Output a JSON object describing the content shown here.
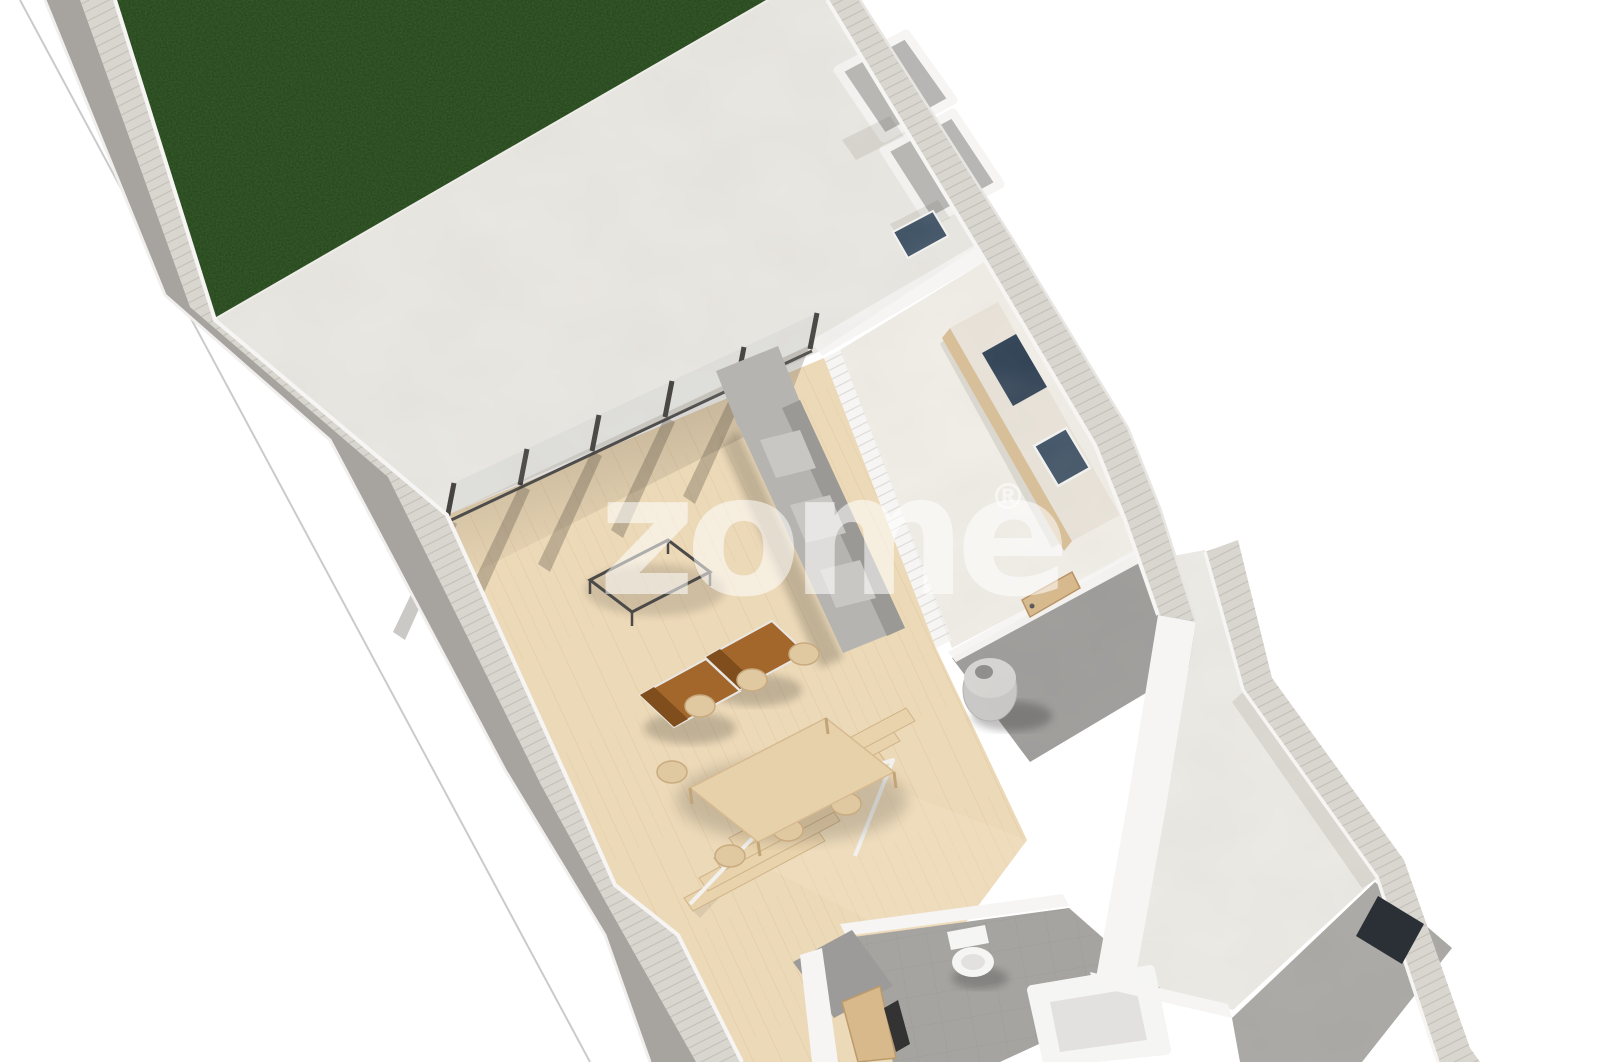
{
  "watermark": {
    "text": "zome",
    "reg": "®",
    "color": "rgba(255,255,255,0.55)"
  },
  "scene": {
    "description": "3D isometric render of a narrow townhouse ground-floor plan",
    "areas": [
      "garden-lawn",
      "front-patio",
      "living-room",
      "kitchen",
      "dining-area",
      "stairs",
      "bathroom",
      "utility-corridor",
      "back-yard",
      "storage-rooms",
      "garage-patio"
    ]
  },
  "c": {
    "background": "#ffffff",
    "property_line": "#cbcbcb",
    "grass": "#234119",
    "patio": "#eae8e3",
    "yard": "#edebe6",
    "corridor": "#9c9b99",
    "garage": "#a8a7a4",
    "wood": "#ecd9b8",
    "wall_top": "#d9d6d0",
    "wall_face": "#a7a4a0",
    "wall_white": "#f6f5f3",
    "divider": "#f0efec",
    "kitchen_floor": "#f2efe9",
    "counter_top": "#eae4da",
    "counter_side": "#d9bf97",
    "navy": "#3d5164",
    "navy_dark": "#2f4155",
    "sofa": "#b6b4b1",
    "sofa_light": "#c9c7c4",
    "sofa_dark": "#9b9996",
    "armchair": "#a3662b",
    "armchair_dark": "#7f4e1c",
    "armchair_frame": "#e9e7e3",
    "dining_wood": "#e7d1ab",
    "chair_wood": "#e0c8a1",
    "stair_wood": "#e9d3ad",
    "landing_wood": "#eedcbc",
    "bath_floor": "#a5a4a1",
    "fixture": "#f5f5f3",
    "fixture_shade": "#e2e1df",
    "heater": "#c9c8c6",
    "heater_dark": "#8e8c8a",
    "door_tan": "#d8b98c",
    "dark_mass": "#2b3036",
    "dark_door": "#333333",
    "rail": "#f2f1ee",
    "curb": "#efede9",
    "glass": "rgba(205,210,210,0.35)",
    "post": "#3f3e3c",
    "shadow": "rgba(70,60,50,0.28)"
  }
}
